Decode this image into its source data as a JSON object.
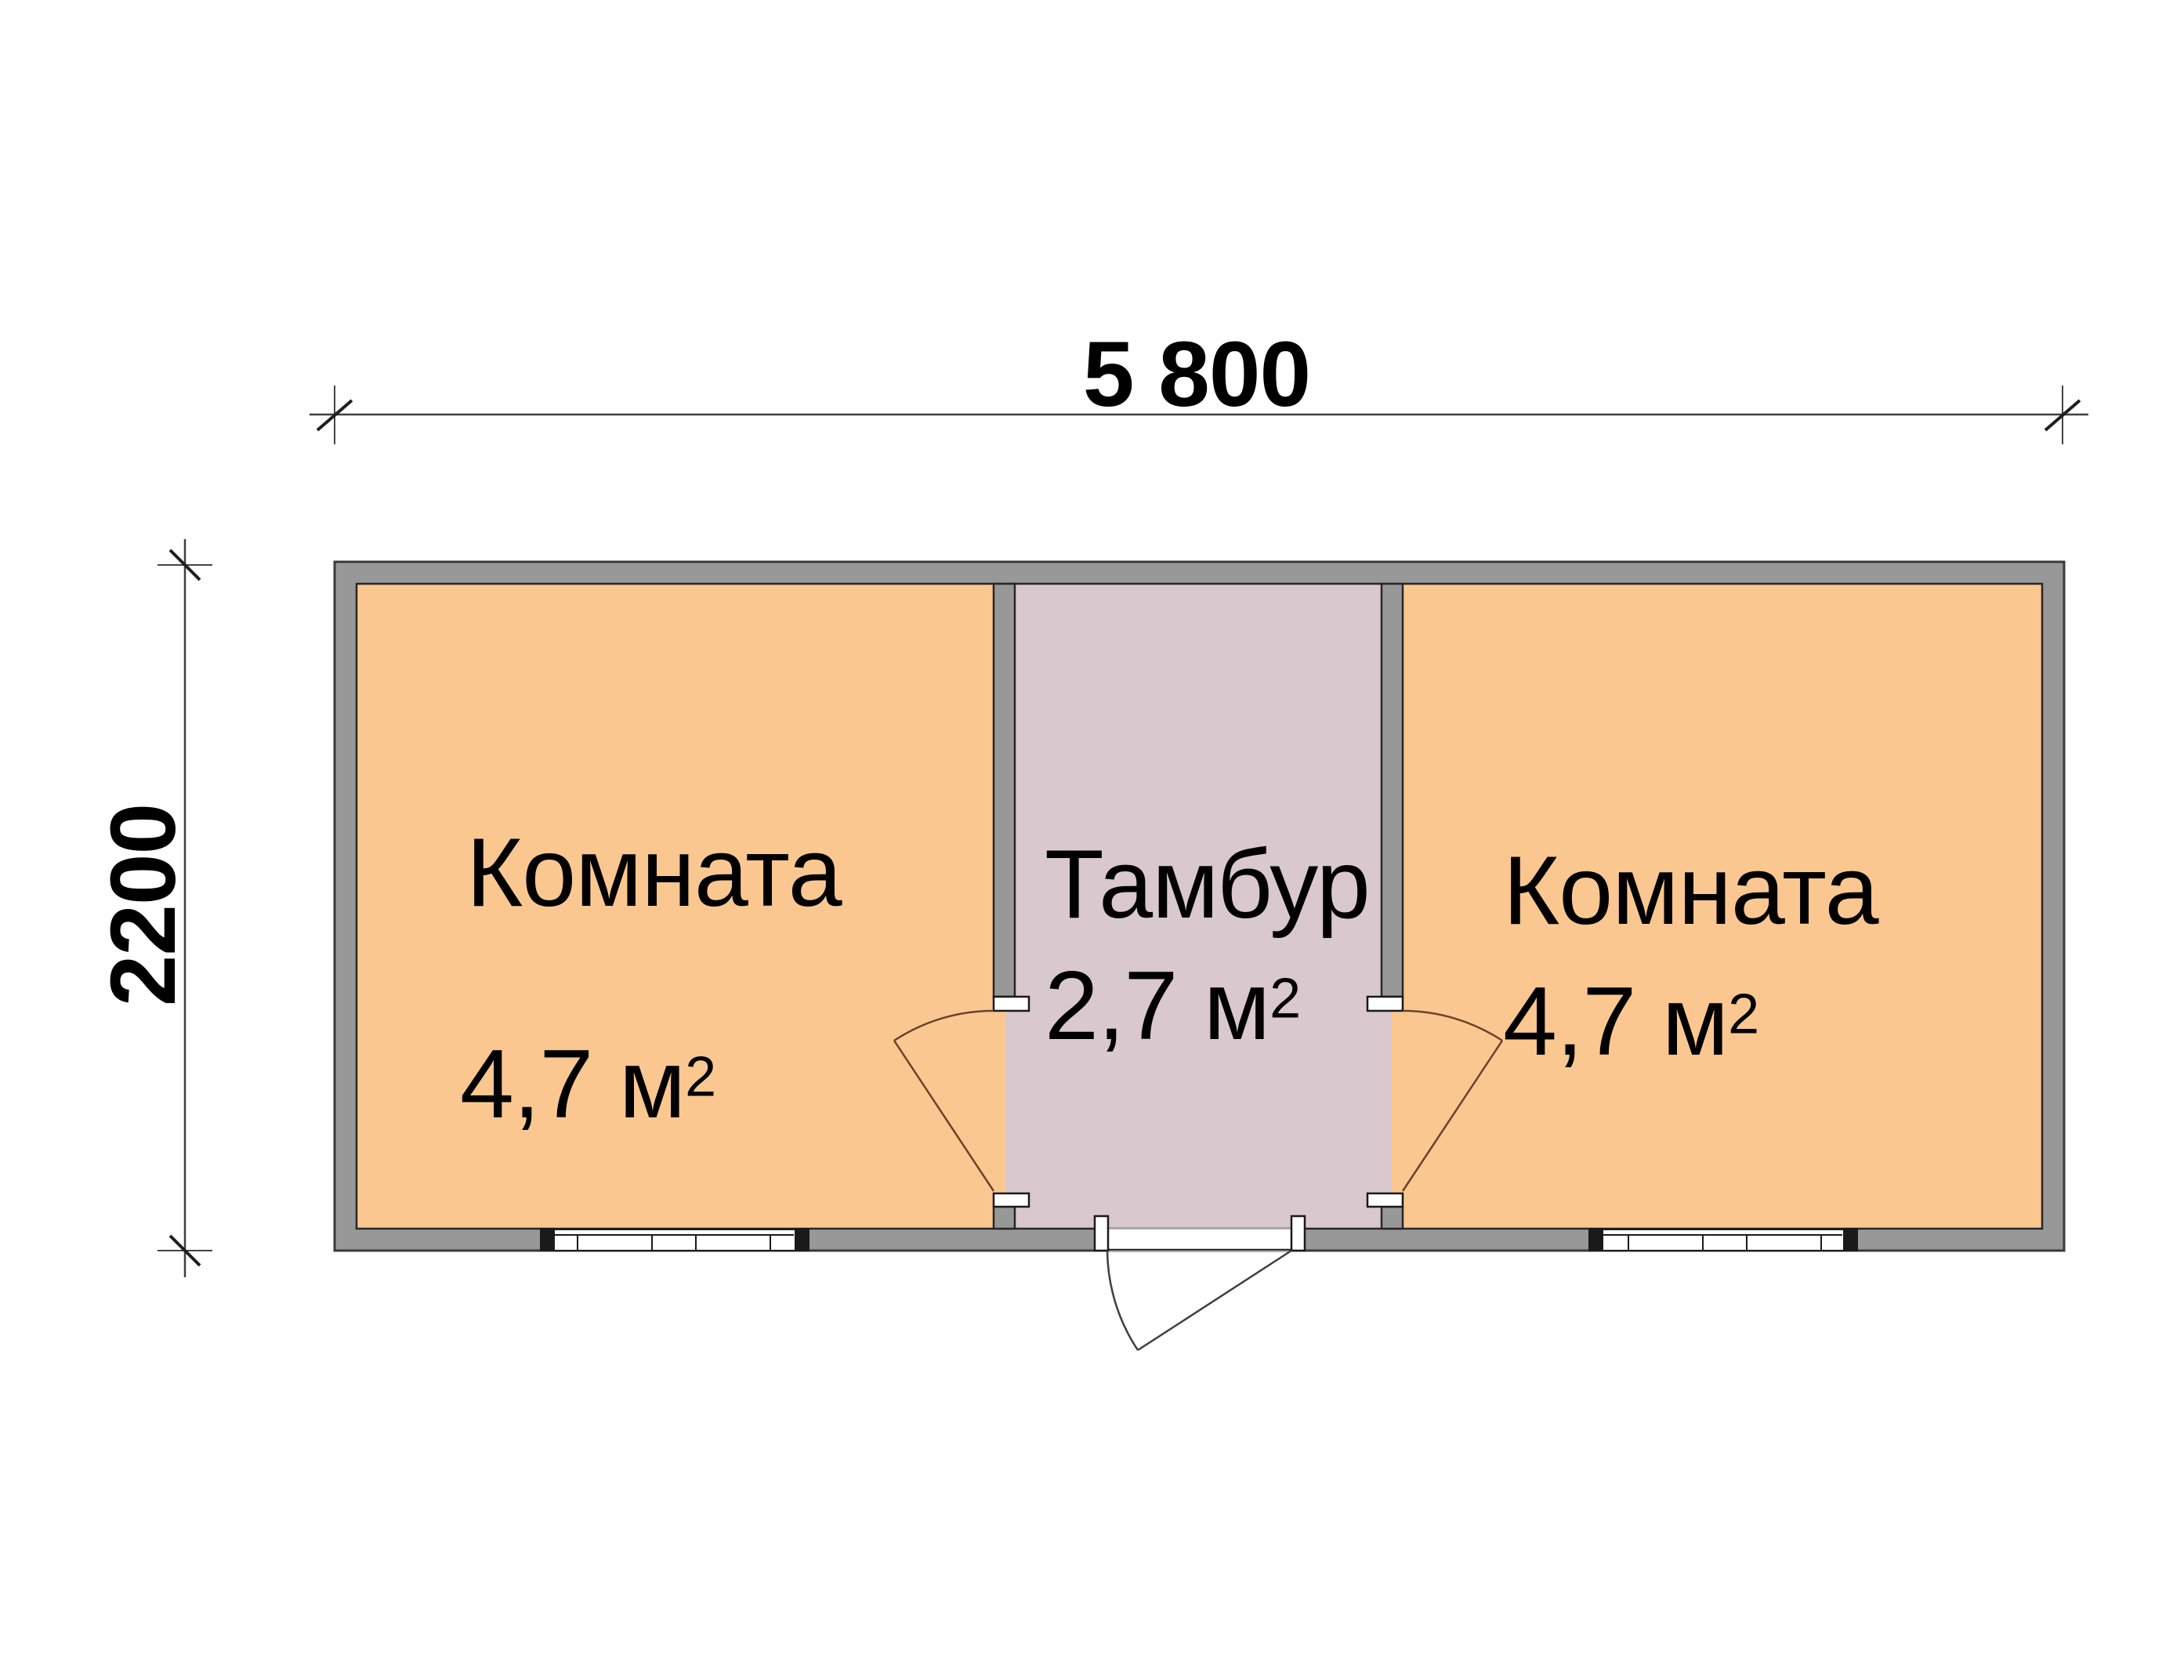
{
  "colors": {
    "wall": "#989898",
    "room": "#FBC791",
    "vestibule": "#D9C8CE",
    "line": "#3a3a3a",
    "innerline": "#262626",
    "doorroom": "#6b432b",
    "doorentry": "#3f3f3f"
  },
  "dimensions": {
    "top_label": "5 800",
    "left_label": "2200"
  },
  "rooms": {
    "left": {
      "name": "Комната",
      "area": "4,7 м",
      "area_sup": "2"
    },
    "vestibule": {
      "name": "Тамбур",
      "area": "2,7 м",
      "area_sup": "2"
    },
    "right": {
      "name": "Комната",
      "area": "4,7 м",
      "area_sup": "2"
    }
  }
}
